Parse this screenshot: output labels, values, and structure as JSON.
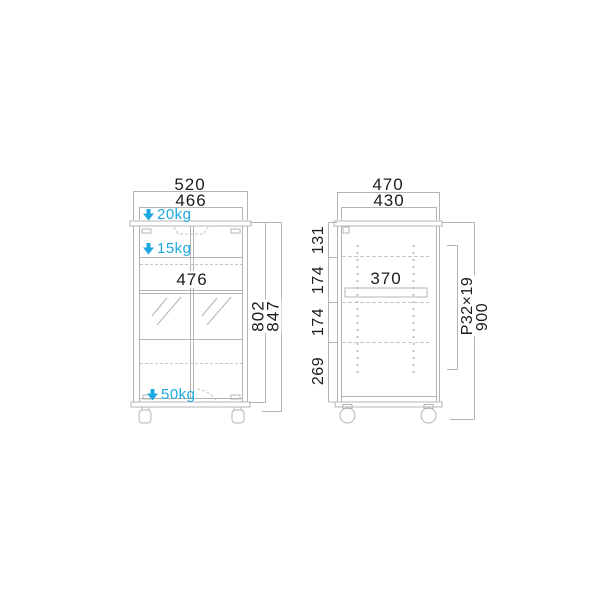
{
  "front_view": {
    "outer_width": "520",
    "inner_width": "466",
    "top_load": "20kg",
    "shelf_load": "15kg",
    "inner_shelf_width": "476",
    "bottom_load": "50kg",
    "body_height": "802",
    "total_height": "847"
  },
  "side_view": {
    "outer_depth": "470",
    "inner_depth": "430",
    "top_section": "131",
    "upper_section": "174",
    "middle_section": "174",
    "bottom_section": "269",
    "shelf_depth": "370",
    "hole_pitch": "P32×19",
    "total_height": "900"
  },
  "colors": {
    "accent": "#1fa9e0",
    "line": "#b4b4b4",
    "line_light": "#c6c6c6",
    "text": "#1c1c1c",
    "background": "#ffffff"
  },
  "icons": {
    "load_arrow": "down-arrow"
  }
}
